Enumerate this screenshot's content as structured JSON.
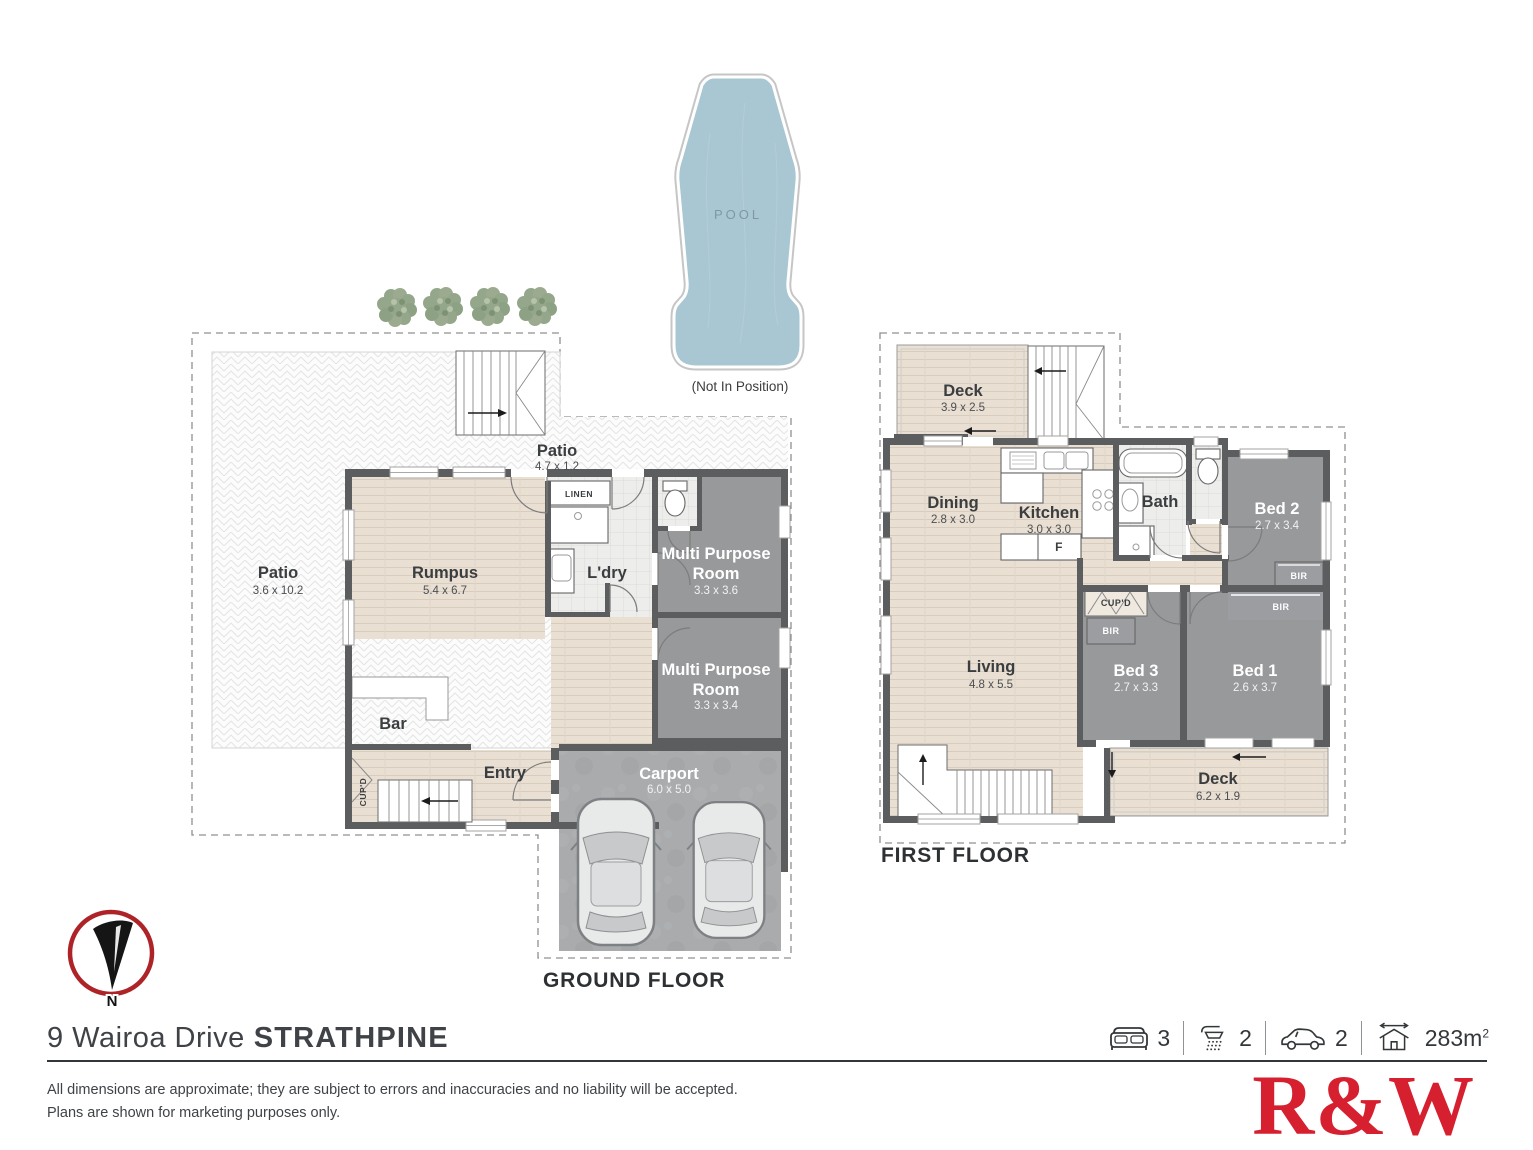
{
  "pool": {
    "label": "POOL",
    "caption": "(Not In Position)"
  },
  "ground_floor": {
    "title": "GROUND FLOOR",
    "rooms": {
      "patio_main": {
        "name": "Patio",
        "dims": "3.6 x 10.2"
      },
      "patio_strip": {
        "name": "Patio",
        "dims": "4.7 x 1.2"
      },
      "rumpus": {
        "name": "Rumpus",
        "dims": "5.4 x 6.7"
      },
      "laundry": {
        "name": "L'dry"
      },
      "linen": {
        "name": "LINEN"
      },
      "mpr1": {
        "name_line1": "Multi Purpose",
        "name_line2": "Room",
        "dims": "3.3 x 3.6"
      },
      "mpr2": {
        "name_line1": "Multi Purpose",
        "name_line2": "Room",
        "dims": "3.3 x 3.4"
      },
      "bar": {
        "name": "Bar"
      },
      "cupboard": {
        "name": "CUP'D"
      },
      "entry": {
        "name": "Entry"
      },
      "carport": {
        "name": "Carport",
        "dims": "6.0 x 5.0"
      }
    }
  },
  "first_floor": {
    "title": "FIRST FLOOR",
    "rooms": {
      "deck_top": {
        "name": "Deck",
        "dims": "3.9 x 2.5"
      },
      "dining": {
        "name": "Dining",
        "dims": "2.8 x 3.0"
      },
      "kitchen": {
        "name": "Kitchen",
        "dims": "3.0 x 3.0"
      },
      "fridge": {
        "name": "F"
      },
      "bath": {
        "name": "Bath"
      },
      "bed2": {
        "name": "Bed 2",
        "dims": "2.7 x 3.4"
      },
      "bed3": {
        "name": "Bed 3",
        "dims": "2.7 x 3.3"
      },
      "bed1": {
        "name": "Bed 1",
        "dims": "2.6 x 3.7"
      },
      "living": {
        "name": "Living",
        "dims": "4.8 x 5.5"
      },
      "deck_bottom": {
        "name": "Deck",
        "dims": "6.2 x 1.9"
      },
      "cupboard": {
        "name": "CUP'D"
      },
      "robe": {
        "name": "BIR"
      }
    }
  },
  "compass": {
    "label": "N"
  },
  "footer": {
    "address_street": "9 Wairoa Drive",
    "address_suburb": "STRATHPINE",
    "stats": [
      {
        "icon": "bed-icon",
        "value": "3"
      },
      {
        "icon": "shower-icon",
        "value": "2"
      },
      {
        "icon": "car-icon",
        "value": "2"
      },
      {
        "icon": "area-icon",
        "value": "283m",
        "sup": "2"
      }
    ],
    "disclaimer_line1": "All dimensions are approximate; they are subject to errors and inaccuracies and no liability will be accepted.",
    "disclaimer_line2": "Plans are shown for marketing purposes only.",
    "logo": "R&W"
  },
  "colors": {
    "brand_red": "#D6202F",
    "compass_red": "#AE2328",
    "pool_fill": "#A9C7D3",
    "wall": "#5C5D5E",
    "room_gray": "#98999B",
    "wood": "#E9DFD3"
  }
}
